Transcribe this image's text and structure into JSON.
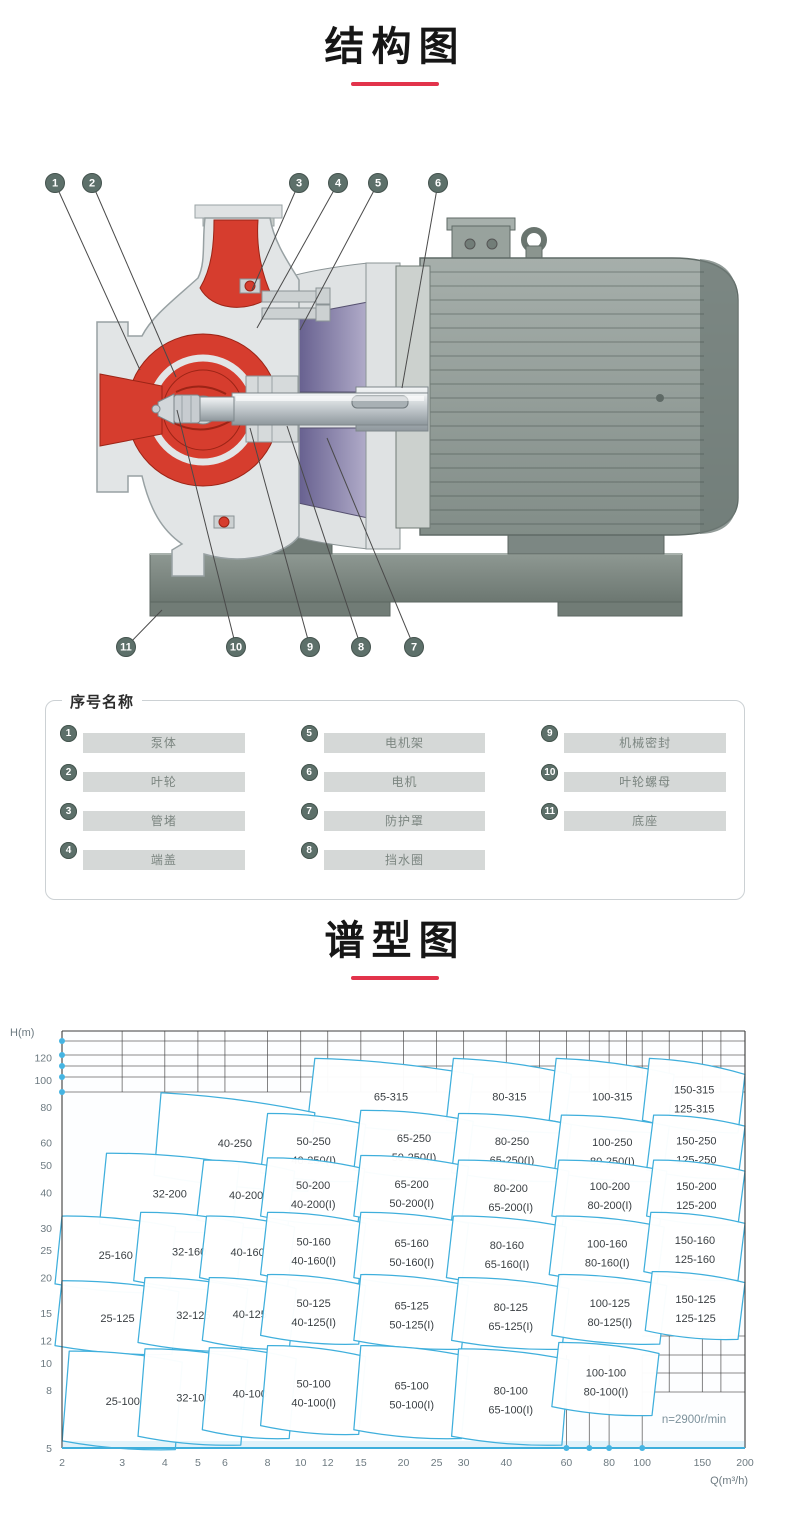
{
  "accent": {
    "underline": "#e2334b",
    "cyan": "#3fafdc",
    "red_part": "#d63d2e",
    "purple_part": "#575083"
  },
  "titles": {
    "structure": "结构图",
    "spectrum": "谱型图"
  },
  "legend": {
    "header": "序号名称",
    "columns": [
      [
        {
          "num": "1",
          "label": "泵体"
        },
        {
          "num": "2",
          "label": "叶轮"
        },
        {
          "num": "3",
          "label": "管堵"
        },
        {
          "num": "4",
          "label": "端盖"
        }
      ],
      [
        {
          "num": "5",
          "label": "电机架"
        },
        {
          "num": "6",
          "label": "电机"
        },
        {
          "num": "7",
          "label": "防护罩"
        },
        {
          "num": "8",
          "label": "挡水圈"
        }
      ],
      [
        {
          "num": "9",
          "label": "机械密封"
        },
        {
          "num": "10",
          "label": "叶轮螺母"
        },
        {
          "num": "11",
          "label": "底座"
        }
      ]
    ]
  },
  "diagram": {
    "callouts": [
      {
        "num": "1",
        "cx": 55,
        "cy": 53,
        "tx": 140,
        "ty": 240
      },
      {
        "num": "2",
        "cx": 92,
        "cy": 53,
        "tx": 176,
        "ty": 247
      },
      {
        "num": "3",
        "cx": 299,
        "cy": 53,
        "tx": 252,
        "ty": 160
      },
      {
        "num": "4",
        "cx": 338,
        "cy": 53,
        "tx": 257,
        "ty": 198
      },
      {
        "num": "5",
        "cx": 378,
        "cy": 53,
        "tx": 300,
        "ty": 200
      },
      {
        "num": "6",
        "cx": 438,
        "cy": 53,
        "tx": 402,
        "ty": 258
      },
      {
        "num": "7",
        "cx": 414,
        "cy": 517,
        "tx": 327,
        "ty": 308
      },
      {
        "num": "8",
        "cx": 361,
        "cy": 517,
        "tx": 287,
        "ty": 296
      },
      {
        "num": "9",
        "cx": 310,
        "cy": 517,
        "tx": 250,
        "ty": 298
      },
      {
        "num": "10",
        "cx": 236,
        "cy": 517,
        "tx": 177,
        "ty": 280
      },
      {
        "num": "11",
        "cx": 126,
        "cy": 517,
        "tx": 162,
        "ty": 480
      }
    ]
  },
  "chart_data": {
    "type": "area",
    "title": "谱型图",
    "xlabel": "Q(m³/h)",
    "ylabel": "H(m)",
    "x_ticks": [
      2,
      3,
      4,
      5,
      6,
      8,
      10,
      12,
      15,
      20,
      25,
      30,
      40,
      60,
      80,
      100,
      150,
      200
    ],
    "y_ticks": [
      120,
      100,
      80,
      60,
      50,
      40,
      30,
      25,
      20,
      15,
      12,
      10,
      8,
      5
    ],
    "xlim": [
      2,
      200
    ],
    "ylim": [
      5,
      140
    ],
    "scale": "log-log",
    "legend_position": "none",
    "annotation": "n=2900r/min",
    "grid_hints": {
      "top_rule_y": [
        21,
        35,
        46,
        57,
        72
      ],
      "top_grid_bottom": 72,
      "top_vertical_q": [
        3,
        4,
        5,
        6,
        8,
        10,
        12,
        15,
        20,
        25,
        30,
        40,
        50,
        60,
        70,
        80,
        90,
        100,
        120,
        150,
        170,
        200
      ],
      "br_horizontal_y": [
        316,
        335,
        353,
        372
      ],
      "br_vertical_q_short": [
        120,
        150,
        170,
        200
      ],
      "br_vertical_q_long": [
        60,
        70,
        80,
        100
      ],
      "axis_dot_flows": [
        60,
        70,
        80,
        100
      ],
      "annotation_pos": {
        "x": 694,
        "y": 403
      }
    },
    "cells": [
      {
        "labels": [
          "65-315"
        ],
        "q": [
          11,
          32
        ],
        "h": [
          72,
          119
        ],
        "drop": 16
      },
      {
        "labels": [
          "80-315"
        ],
        "q": [
          28,
          62
        ],
        "h": [
          72,
          119
        ],
        "drop": 16
      },
      {
        "labels": [
          "100-315"
        ],
        "q": [
          56,
          124
        ],
        "h": [
          72,
          119
        ],
        "drop": 16
      },
      {
        "labels": [
          "150-315",
          "125-315"
        ],
        "q": [
          105,
          200
        ],
        "h": [
          72,
          119
        ],
        "drop": 16
      },
      {
        "labels": [
          "40-250"
        ],
        "q": [
          3.9,
          11
        ],
        "h": [
          46,
          90
        ],
        "drop": 20
      },
      {
        "labels": [
          "50-250",
          "40-250(I)"
        ],
        "q": [
          8,
          15.5
        ],
        "h": [
          47,
          76
        ]
      },
      {
        "labels": [
          "65-250",
          "50-250(I)"
        ],
        "q": [
          15,
          32
        ],
        "h": [
          48,
          78
        ]
      },
      {
        "labels": [
          "80-250",
          "65-250(I)"
        ],
        "q": [
          29,
          62
        ],
        "h": [
          47,
          76
        ]
      },
      {
        "labels": [
          "100-250",
          "80-250(I)"
        ],
        "q": [
          58,
          120
        ],
        "h": [
          47,
          75
        ]
      },
      {
        "labels": [
          "150-250",
          "125-250"
        ],
        "q": [
          108,
          200
        ],
        "h": [
          48,
          75
        ]
      },
      {
        "labels": [
          "32-200"
        ],
        "q": [
          2.7,
          6.6
        ],
        "h": [
          31,
          55
        ]
      },
      {
        "labels": [
          "40-200"
        ],
        "q": [
          5.2,
          9.6
        ],
        "h": [
          32,
          52
        ]
      },
      {
        "labels": [
          "50-200",
          "40-200(I)"
        ],
        "q": [
          8,
          15.4
        ],
        "h": [
          33,
          53
        ]
      },
      {
        "labels": [
          "65-200",
          "50-200(I)"
        ],
        "q": [
          15,
          31
        ],
        "h": [
          33,
          54
        ]
      },
      {
        "labels": [
          "80-200",
          "65-200(I)"
        ],
        "q": [
          29,
          61
        ],
        "h": [
          32,
          52
        ]
      },
      {
        "labels": [
          "100-200",
          "80-200(I)"
        ],
        "q": [
          57,
          118
        ],
        "h": [
          33,
          52
        ]
      },
      {
        "labels": [
          "150-200",
          "125-200"
        ],
        "q": [
          108,
          200
        ],
        "h": [
          33,
          52
        ]
      },
      {
        "labels": [
          "25-160"
        ],
        "q": [
          2,
          4.3
        ],
        "h": [
          19,
          33
        ]
      },
      {
        "labels": [
          "32-160"
        ],
        "q": [
          3.4,
          6.8
        ],
        "h": [
          19.5,
          34
        ]
      },
      {
        "labels": [
          "40-160"
        ],
        "q": [
          5.3,
          9.6
        ],
        "h": [
          20,
          33
        ]
      },
      {
        "labels": [
          "50-160",
          "40-160(I)"
        ],
        "q": [
          8,
          15.5
        ],
        "h": [
          20.5,
          34
        ]
      },
      {
        "labels": [
          "65-160",
          "50-160(I)"
        ],
        "q": [
          15,
          31
        ],
        "h": [
          20,
          34
        ]
      },
      {
        "labels": [
          "80-160",
          "65-160(I)"
        ],
        "q": [
          28,
          60
        ],
        "h": [
          20,
          33
        ]
      },
      {
        "labels": [
          "100-160",
          "80-160(I)"
        ],
        "q": [
          56,
          116
        ],
        "h": [
          20.5,
          33
        ]
      },
      {
        "labels": [
          "150-160",
          "125-160"
        ],
        "q": [
          106,
          200
        ],
        "h": [
          21,
          34
        ]
      },
      {
        "labels": [
          "25-125"
        ],
        "q": [
          2,
          4.4
        ],
        "h": [
          11.5,
          19.5
        ]
      },
      {
        "labels": [
          "32-125"
        ],
        "q": [
          3.5,
          7
        ],
        "h": [
          11.8,
          20
        ]
      },
      {
        "labels": [
          "40-125"
        ],
        "q": [
          5.4,
          9.7
        ],
        "h": [
          12,
          20
        ]
      },
      {
        "labels": [
          "50-125",
          "40-125(I)"
        ],
        "q": [
          8,
          15.5
        ],
        "h": [
          12.5,
          20.5
        ]
      },
      {
        "labels": [
          "65-125",
          "50-125(I)"
        ],
        "q": [
          15,
          31
        ],
        "h": [
          12,
          20.5
        ]
      },
      {
        "labels": [
          "80-125",
          "65-125(I)"
        ],
        "q": [
          29,
          61
        ],
        "h": [
          12,
          20
        ]
      },
      {
        "labels": [
          "100-125",
          "80-125(I)"
        ],
        "q": [
          57,
          118
        ],
        "h": [
          12.5,
          20.5
        ]
      },
      {
        "labels": [
          "150-125",
          "125-125"
        ],
        "q": [
          107,
          200
        ],
        "h": [
          13,
          21
        ]
      },
      {
        "labels": [
          "25-100"
        ],
        "q": [
          2.1,
          4.5
        ],
        "h": [
          5.3,
          11
        ]
      },
      {
        "labels": [
          "32-100"
        ],
        "q": [
          3.5,
          7
        ],
        "h": [
          5.5,
          11.2
        ]
      },
      {
        "labels": [
          "40-100"
        ],
        "q": [
          5.4,
          9.7
        ],
        "h": [
          5.8,
          11.3
        ]
      },
      {
        "labels": [
          "50-100",
          "40-100(I)"
        ],
        "q": [
          8,
          15.5
        ],
        "h": [
          6,
          11.5
        ]
      },
      {
        "labels": [
          "65-100",
          "50-100(I)"
        ],
        "q": [
          15,
          31
        ],
        "h": [
          5.8,
          11.5
        ]
      },
      {
        "labels": [
          "80-100",
          "65-100(I)"
        ],
        "q": [
          29,
          61
        ],
        "h": [
          5.5,
          11.2
        ]
      },
      {
        "labels": [
          "100-100",
          "80-100(I)"
        ],
        "q": [
          57,
          112
        ],
        "h": [
          7,
          11.8
        ]
      }
    ]
  }
}
